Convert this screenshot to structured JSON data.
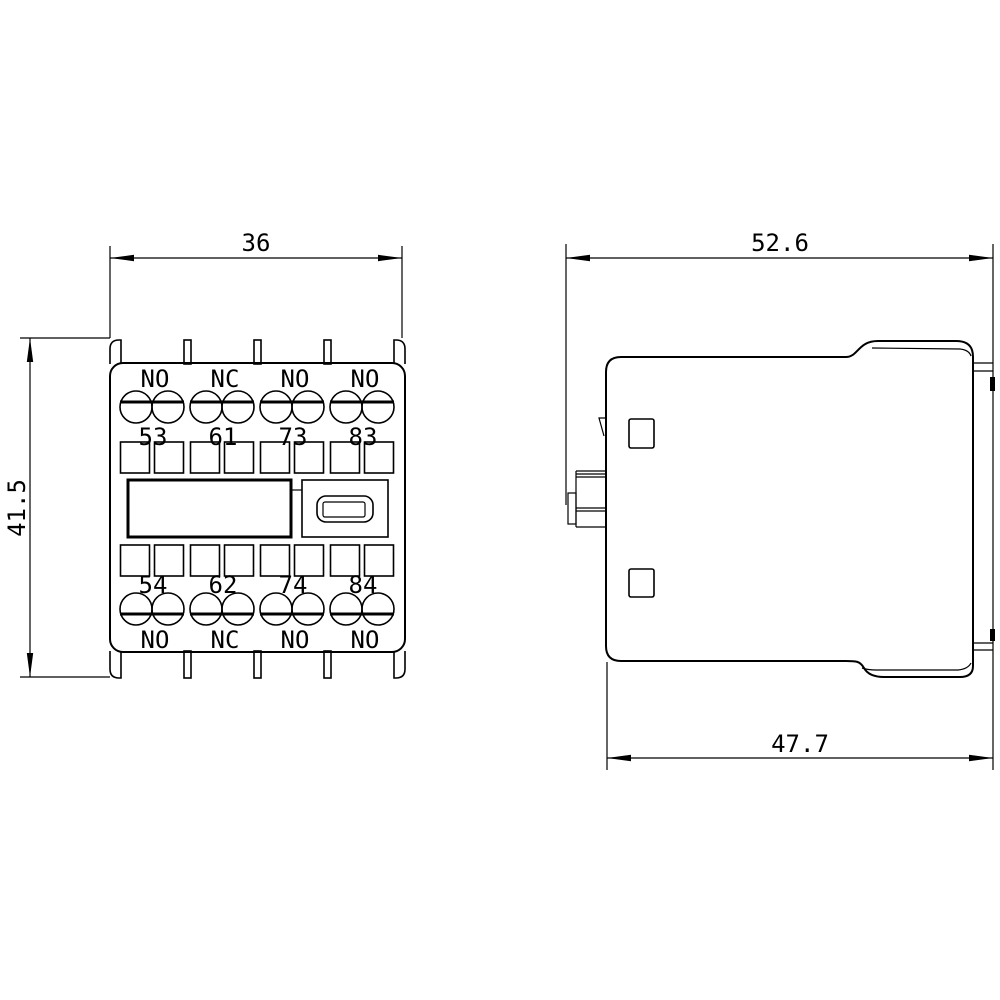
{
  "drawing": {
    "background": "#ffffff",
    "line_color": "#000000",
    "front_view": {
      "width_dim": "36",
      "height_dim": "41.5",
      "top_contact_labels": [
        "NO",
        "NC",
        "NO",
        "NO"
      ],
      "top_terminal_numbers": [
        "53",
        "61",
        "73",
        "83"
      ],
      "bottom_terminal_numbers": [
        "54",
        "62",
        "74",
        "84"
      ],
      "bottom_contact_labels": [
        "NO",
        "NC",
        "NO",
        "NO"
      ]
    },
    "side_view": {
      "overall_width_dim": "52.6",
      "body_width_dim": "47.7"
    }
  }
}
